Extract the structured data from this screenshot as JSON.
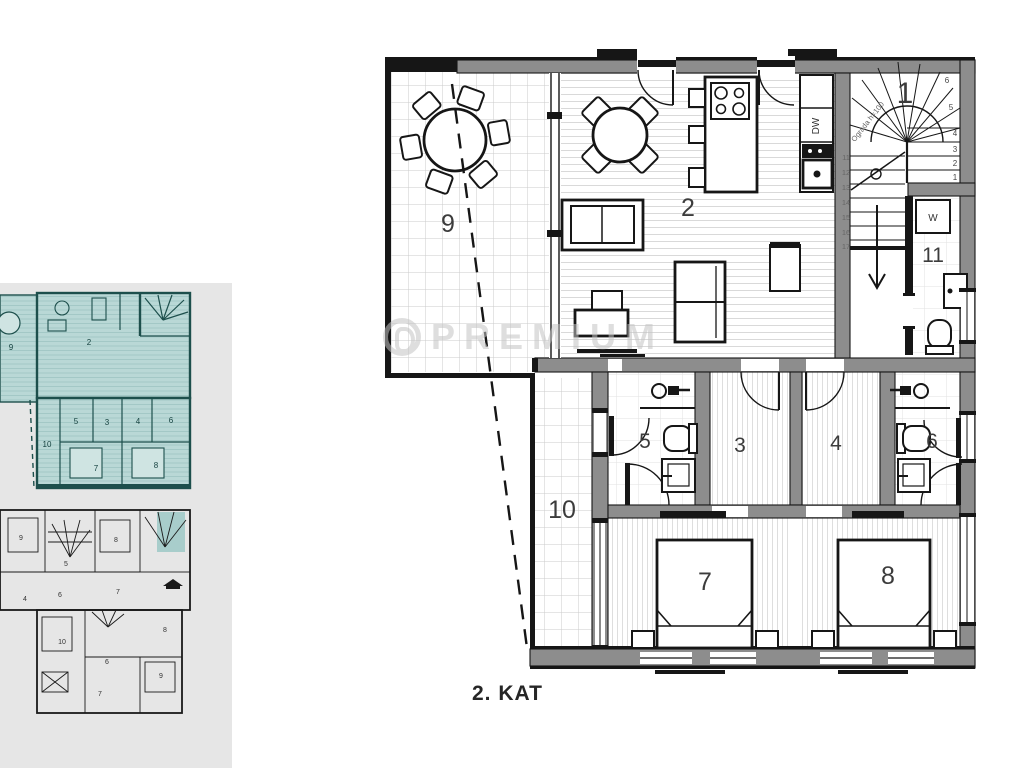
{
  "title": "2. KAT",
  "watermark": "PREMIUM",
  "colors": {
    "highlight_teal": "#b9d8d6",
    "teal_line": "#1d4f4c",
    "wall_gray": "#8d8d8d",
    "panel_gray": "#e6e6e6",
    "watermark_gray": "#c4c4c4"
  },
  "main_plan": {
    "room_labels": {
      "1": "1",
      "2": "2",
      "3": "3",
      "4": "4",
      "5": "5",
      "6": "6",
      "7": "7",
      "8": "8",
      "9": "9",
      "10": "10",
      "11": "11"
    },
    "appliances": {
      "washer": "W",
      "dishwasher": "DW"
    },
    "stair": {
      "note": "Ograda h=100",
      "right_steps": [
        "6",
        "5",
        "4",
        "3",
        "2",
        "1"
      ],
      "left_steps": [
        "11",
        "12",
        "13",
        "14",
        "15",
        "16",
        "17"
      ]
    }
  },
  "thumbnails": {
    "floor2": {
      "labels": {
        "9": "9",
        "2": "2",
        "10": "10",
        "5": "5",
        "3": "3",
        "4": "4",
        "6": "6",
        "7": "7",
        "8": "8"
      }
    },
    "floor1": {
      "labels": {
        "u9": "9",
        "u5": "5",
        "u8": "8",
        "u4": "4",
        "u6": "6",
        "u7": "7",
        "l10": "10",
        "l8": "8",
        "l6": "6",
        "l9": "9",
        "l7": "7"
      }
    }
  }
}
